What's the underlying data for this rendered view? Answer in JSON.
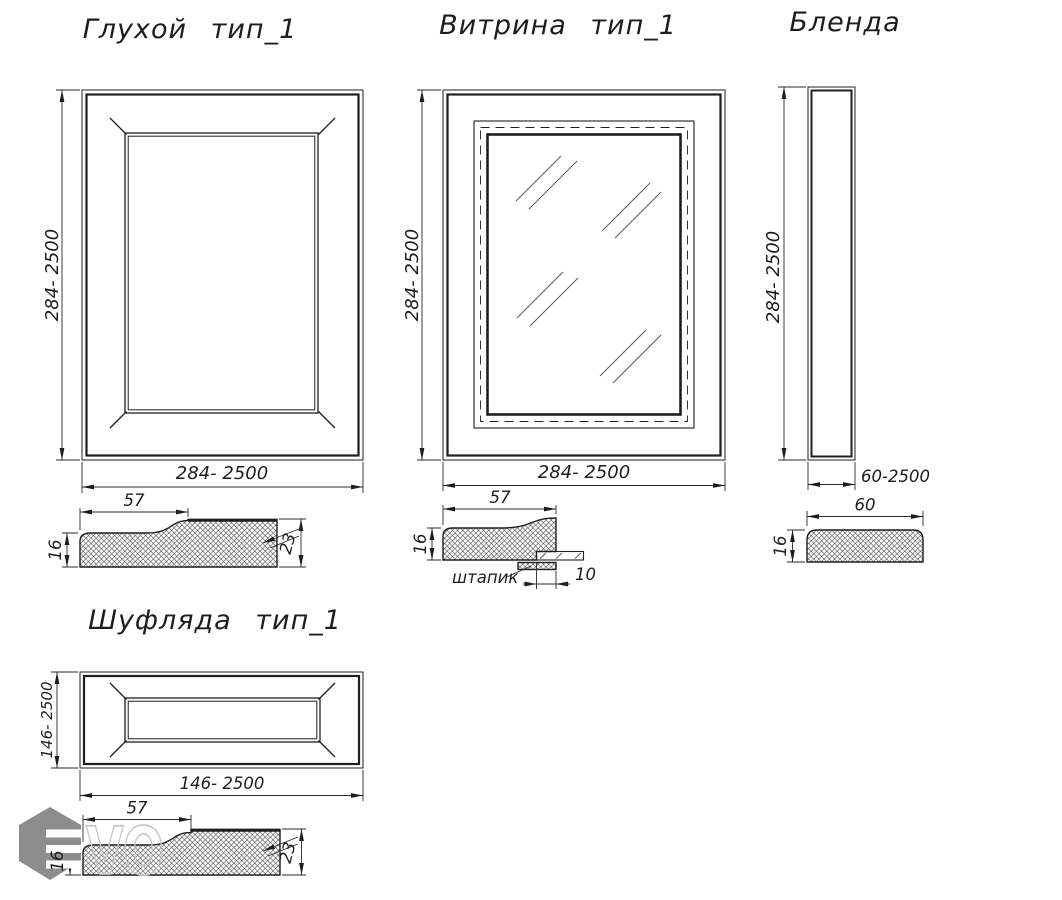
{
  "drawings": {
    "solid_door": {
      "title": "Глухой тип_1",
      "height_dim": "284- 2500",
      "width_dim": "284- 2500",
      "profile": {
        "width": "57",
        "left_height": "16",
        "right_height": "23"
      }
    },
    "vitrina": {
      "title": "Витрина тип_1",
      "height_dim": "284- 2500",
      "width_dim": "284- 2500",
      "profile": {
        "width": "57",
        "left_height": "16",
        "bead_label": "штапик",
        "bead_width": "10"
      }
    },
    "blenda": {
      "title": "Бленда",
      "height_dim": "284- 2500",
      "width_dim": "60-2500",
      "profile": {
        "width": "60",
        "left_height": "16"
      }
    },
    "drawer": {
      "title": "Шуфляда тип_1",
      "height_dim": "146- 2500",
      "width_dim": "146- 2500",
      "profile": {
        "width": "57",
        "left_height": "16",
        "right_height": "23"
      }
    }
  },
  "logo": {
    "text": "VO"
  },
  "colors": {
    "line": "#1f1f1f",
    "hatch": "#3a3a3a",
    "logo_gray": "#8d8d8d",
    "logo_outline": "#c6c6c6",
    "background": "#ffffff"
  }
}
